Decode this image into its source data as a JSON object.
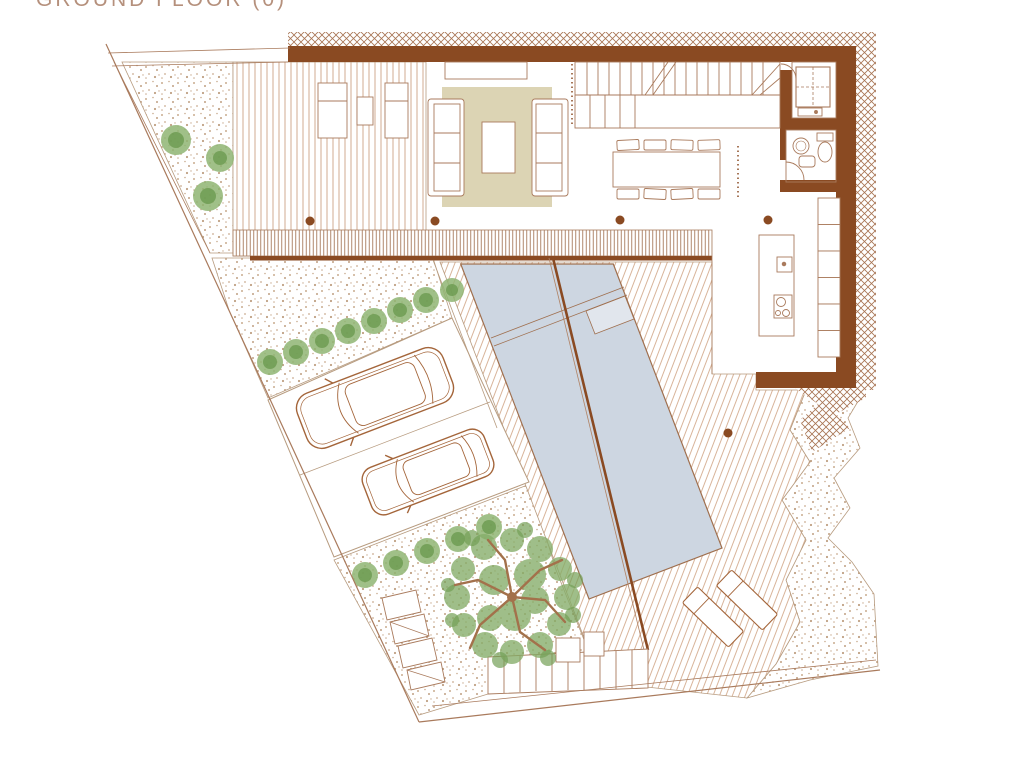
{
  "title": "GROUND FLOOR (0)",
  "colors": {
    "background": "#ffffff",
    "wall": "#8a4a22",
    "drawing_line": "#a97a5c",
    "deck_line": "#d2ab90",
    "pool_water": "#cdd6e1",
    "rug": "#dcd4b4",
    "gravel_dot": "#c9ab8f",
    "plant_green": "#8fb573",
    "tree_branch": "#a3714b",
    "title_text": "#b5907c"
  },
  "plan": {
    "floor_label": "GROUND FLOOR (0)",
    "rooms": [
      "terrace deck",
      "living room",
      "staircase",
      "dining area",
      "kitchen",
      "bathroom",
      "lift-storage",
      "pool deck",
      "pool",
      "driveway",
      "garden"
    ],
    "furniture": [
      "lounge chairs",
      "two sofas",
      "coffee table",
      "console",
      "dining table with 8 chairs",
      "kitchen island with sink and cooktop",
      "wall cabinets",
      "washbasin",
      "toilet",
      "sun loungers"
    ],
    "site_features": [
      "site boundary",
      "gravel areas",
      "shrub rows",
      "tree",
      "two parked cars",
      "garden steps",
      "structural columns"
    ]
  }
}
